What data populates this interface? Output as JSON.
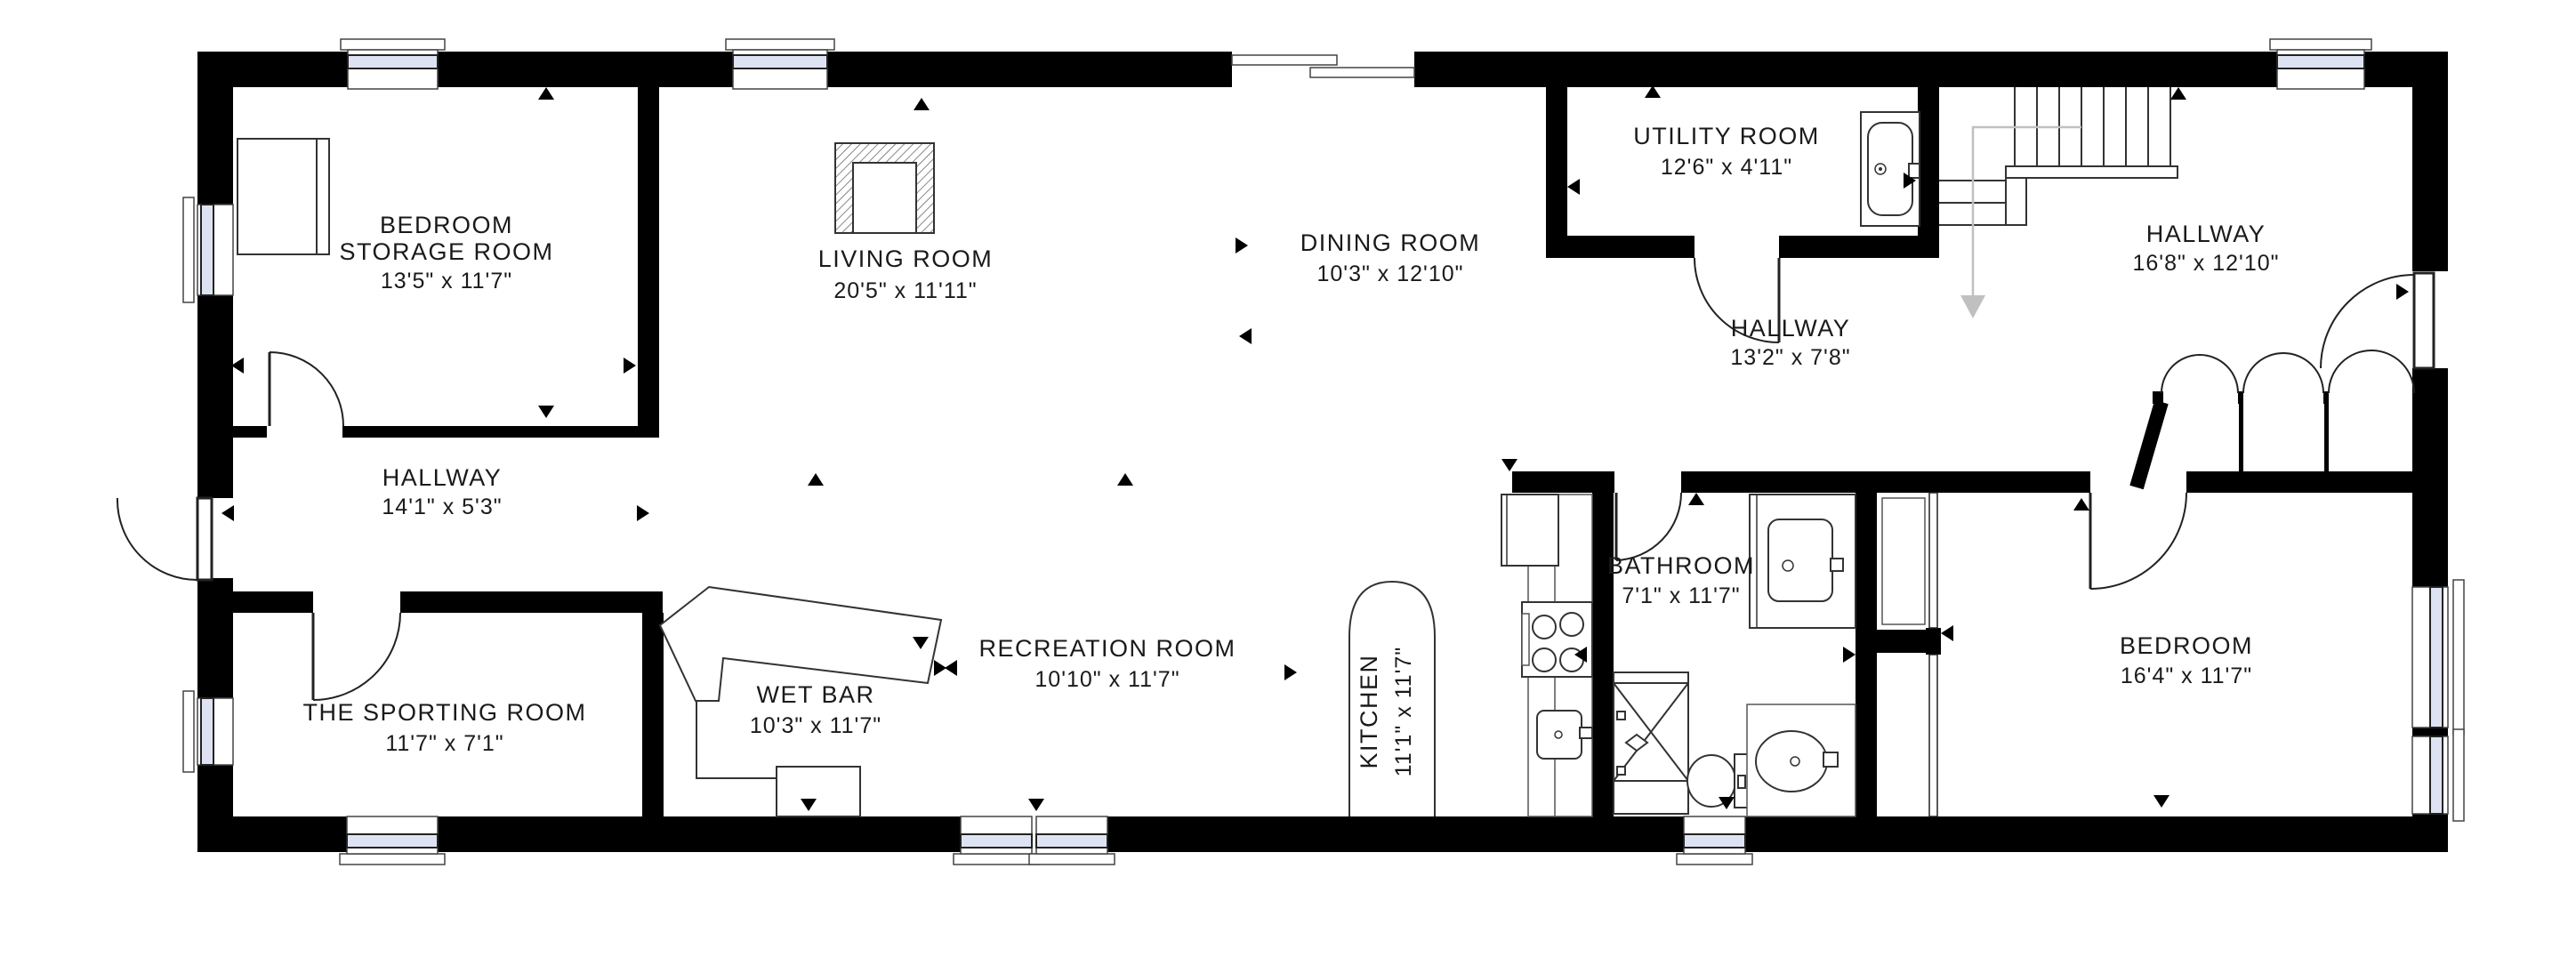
{
  "floorplan": {
    "background": "#ffffff",
    "wall_color": "#000000",
    "glass_color": "#dde3f2",
    "rooms": [
      {
        "id": "bedroom-storage-room",
        "lines": [
          "BEDROOM",
          "STORAGE ROOM"
        ],
        "dims": "13'5\" x 11'7\""
      },
      {
        "id": "living-room",
        "lines": [
          "LIVING ROOM"
        ],
        "dims": "20'5\" x 11'11\""
      },
      {
        "id": "dining-room",
        "lines": [
          "DINING ROOM"
        ],
        "dims": "10'3\" x 12'10\""
      },
      {
        "id": "utility-room",
        "lines": [
          "UTILITY ROOM"
        ],
        "dims": "12'6\" x 4'11\""
      },
      {
        "id": "hallway-right",
        "lines": [
          "HALLWAY"
        ],
        "dims": "16'8\" x 12'10\""
      },
      {
        "id": "hallway-middle",
        "lines": [
          "HALLWAY"
        ],
        "dims": "13'2\" x 7'8\""
      },
      {
        "id": "hallway-left",
        "lines": [
          "HALLWAY"
        ],
        "dims": "14'1\" x 5'3\""
      },
      {
        "id": "the-sporting-room",
        "lines": [
          "THE SPORTING ROOM"
        ],
        "dims": "11'7\" x 7'1\""
      },
      {
        "id": "wet-bar",
        "lines": [
          "WET BAR"
        ],
        "dims": "10'3\" x 11'7\""
      },
      {
        "id": "recreation-room",
        "lines": [
          "RECREATION ROOM"
        ],
        "dims": "10'10\" x 11'7\""
      },
      {
        "id": "kitchen",
        "lines": [
          "KITCHEN"
        ],
        "dims": "11'1\" x 11'7\"",
        "vertical": true
      },
      {
        "id": "bathroom",
        "lines": [
          "BATHROOM"
        ],
        "dims": "7'1\" x 11'7\""
      },
      {
        "id": "bedroom",
        "lines": [
          "BEDROOM"
        ],
        "dims": "16'4\" x 11'7\""
      }
    ]
  }
}
